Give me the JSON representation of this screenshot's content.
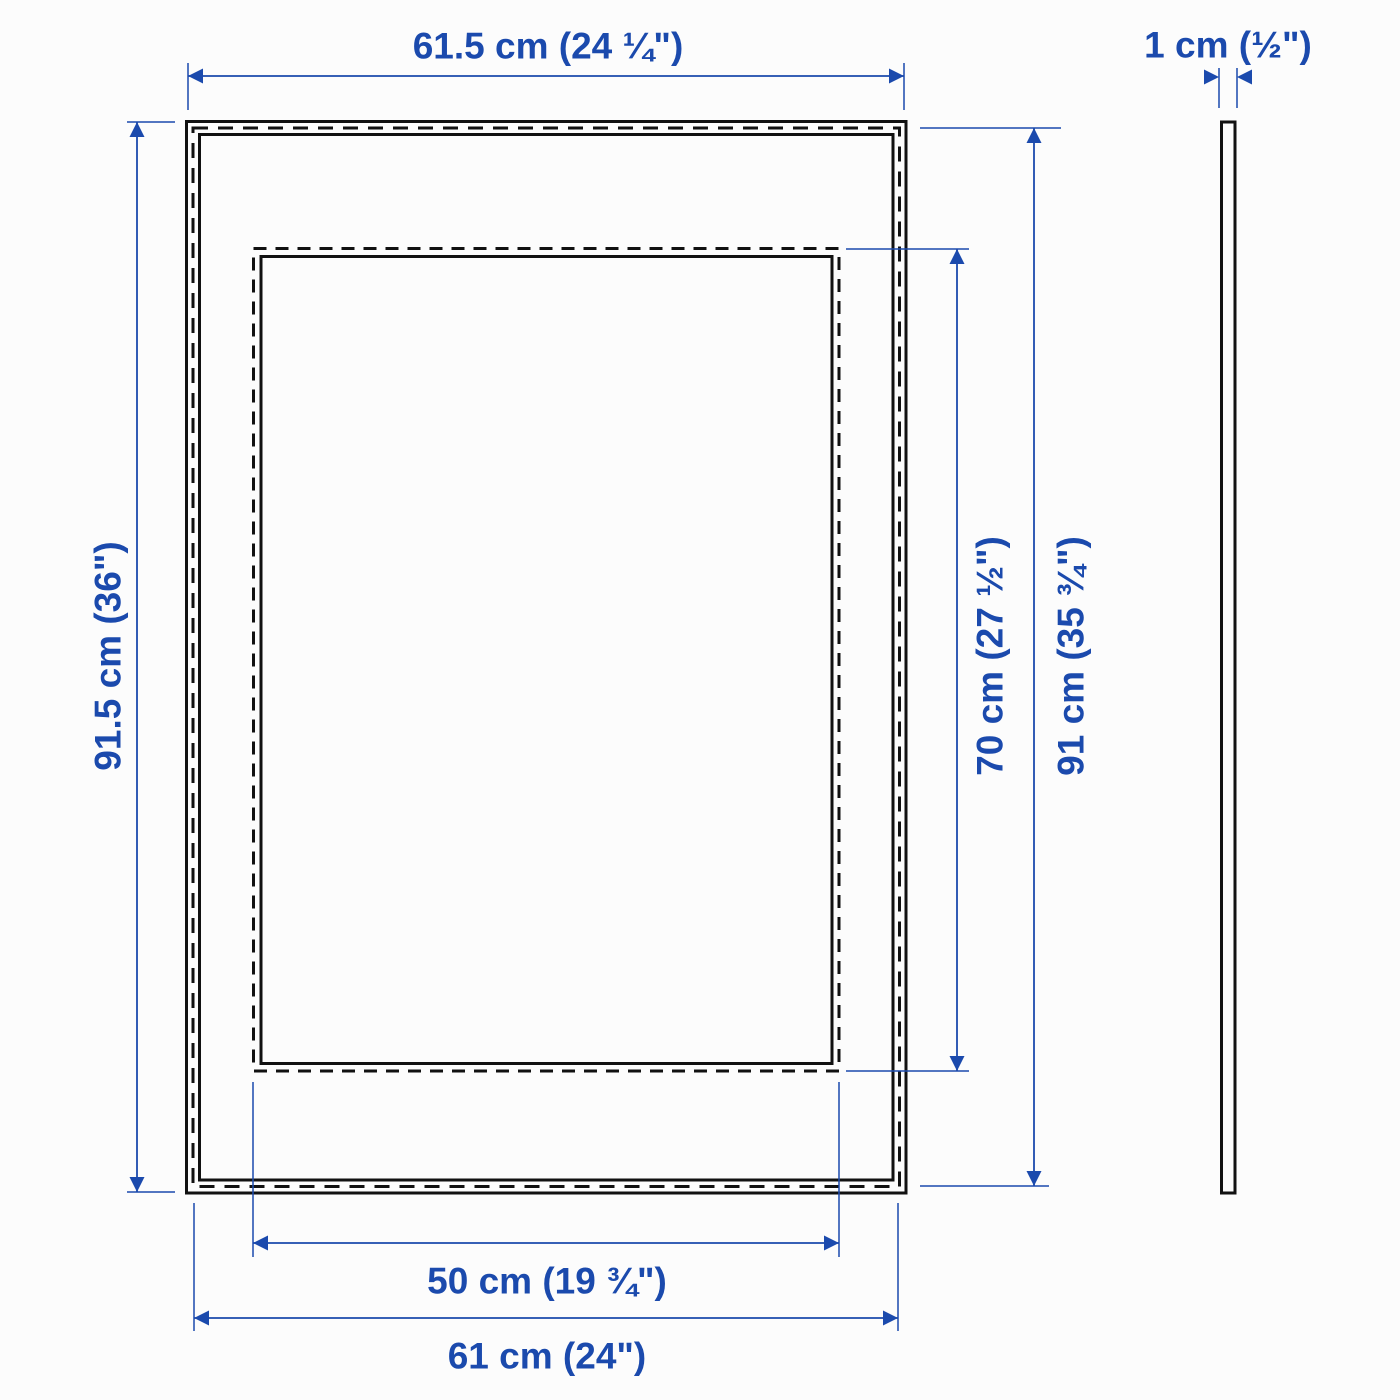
{
  "page": {
    "title": "Picture frame dimension diagram",
    "background": "#fcfcfc"
  },
  "colors": {
    "outline": "#111111",
    "dimension_blue": "#1b4aad"
  },
  "front_view": {
    "frame_width_label": "61.5 cm (24 ¼\")",
    "frame_height_label": "91.5 cm (36\")",
    "opening_width_label": "50 cm (19 ¾\")",
    "opening_height_label": "70 cm (27 ½\")",
    "back_width_label": "61 cm (24\")",
    "back_height_label": "91 cm (35 ¾\")"
  },
  "side_view": {
    "thickness_label": "1 cm (½\")"
  }
}
